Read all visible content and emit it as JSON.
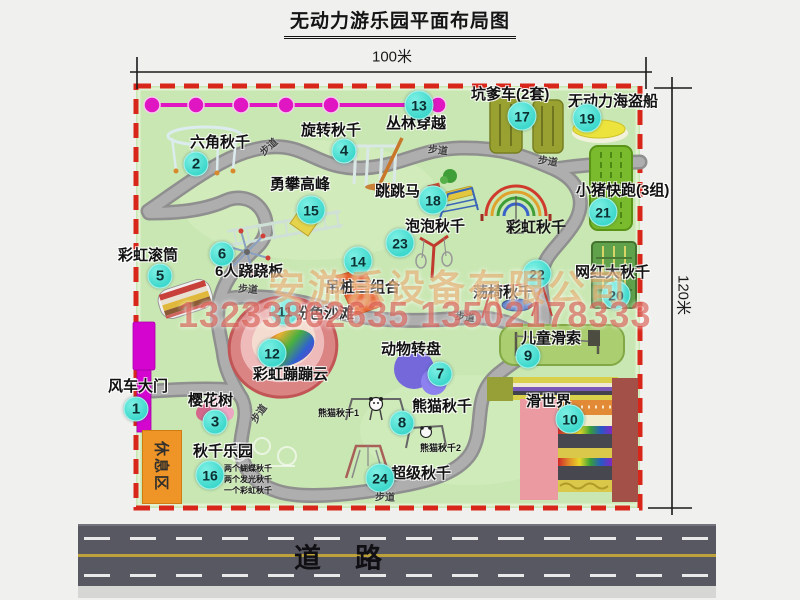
{
  "title": "无动力游乐园平面布局图",
  "dimensions": {
    "width": "100米",
    "height": "120米"
  },
  "road": {
    "label": "道路"
  },
  "watermark": {
    "company": "安游乐设备有限公司",
    "phones": "13233862635 13502178333"
  },
  "rest_area": "休息区",
  "walkway_label": "步道",
  "colors": {
    "park_green": "#c9e7b2",
    "border_red": "#d9261b",
    "marker_cyan": "#3ed8cc",
    "chain_magenta": "#df16c1",
    "gate_magenta": "#d405cf",
    "rest_orange": "#ef9426",
    "road_gray": "#585862"
  },
  "features": [
    {
      "num": "1",
      "label": "风车大门",
      "marker": [
        136,
        409
      ],
      "label_pos": [
        108,
        379
      ]
    },
    {
      "num": "2",
      "label": "六角秋千",
      "marker": [
        196,
        164
      ],
      "label_pos": [
        190,
        135
      ]
    },
    {
      "num": "3",
      "label": "樱花树",
      "marker": [
        215,
        422
      ],
      "label_pos": [
        188,
        393
      ]
    },
    {
      "num": "4",
      "label": "旋转秋千",
      "marker": [
        344,
        151
      ],
      "label_pos": [
        301,
        123
      ]
    },
    {
      "num": "5",
      "label": "彩虹滚筒",
      "marker": [
        160,
        276
      ],
      "label_pos": [
        118,
        248
      ]
    },
    {
      "num": "6",
      "label": "6人跷跷板",
      "marker": [
        222,
        254
      ],
      "label_pos": [
        215,
        264
      ]
    },
    {
      "num": "7",
      "label": "动物转盘",
      "marker": [
        440,
        374
      ],
      "label_pos": [
        381,
        342
      ]
    },
    {
      "num": "8",
      "label": "熊猫秋千",
      "marker": [
        402,
        423
      ],
      "label_pos": [
        412,
        399
      ]
    },
    {
      "num": "9",
      "label": "儿童滑索",
      "marker": [
        528,
        356
      ],
      "label_pos": [
        521,
        331
      ]
    },
    {
      "num": "10",
      "label": "滑世界",
      "marker": [
        570,
        419
      ],
      "label_pos": [
        526,
        394
      ]
    },
    {
      "num": "11",
      "label": "粉色沙滩",
      "marker": [
        285,
        311
      ],
      "label_pos": [
        294,
        306
      ]
    },
    {
      "num": "12",
      "label": "彩虹蹦蹦云",
      "marker": [
        272,
        353
      ],
      "label_pos": [
        253,
        367
      ]
    },
    {
      "num": "13",
      "label": "丛林穿越",
      "marker": [
        419,
        105
      ],
      "label_pos": [
        386,
        116
      ]
    },
    {
      "num": "14",
      "label": "吊桩三组合",
      "marker": [
        358,
        261
      ],
      "label_pos": [
        325,
        280
      ]
    },
    {
      "num": "15",
      "label": "勇攀高峰",
      "marker": [
        311,
        210
      ],
      "label_pos": [
        270,
        177
      ]
    },
    {
      "num": "16",
      "label": "秋千乐园",
      "marker": [
        210,
        475
      ],
      "label_pos": [
        193,
        444
      ]
    },
    {
      "num": "17",
      "label": "坑爹车(2套)",
      "marker": [
        522,
        116
      ],
      "label_pos": [
        471,
        87
      ]
    },
    {
      "num": "18",
      "label": "跳跳马",
      "marker": [
        433,
        200
      ],
      "label_pos": [
        375,
        184
      ]
    },
    {
      "num": "19",
      "label": "无动力海盗船",
      "marker": [
        587,
        118
      ],
      "label_pos": [
        568,
        94
      ]
    },
    {
      "num": "20",
      "label": "网红大秋千",
      "marker": [
        616,
        295
      ],
      "label_pos": [
        575,
        265
      ]
    },
    {
      "num": "21",
      "label": "小猪快跑(3组)",
      "marker": [
        603,
        212
      ],
      "label_pos": [
        576,
        183
      ]
    },
    {
      "num": "22",
      "label": "荡椅秋千",
      "marker": [
        537,
        274
      ],
      "label_pos": [
        473,
        285
      ]
    },
    {
      "num": "23",
      "label": "泡泡秋千",
      "marker": [
        400,
        243
      ],
      "label_pos": [
        405,
        219
      ]
    },
    {
      "num": "24",
      "label": "超级秋千",
      "marker": [
        380,
        478
      ],
      "label_pos": [
        391,
        466
      ]
    }
  ],
  "extra_labels": [
    {
      "text": "彩虹秋千",
      "x": 506,
      "y": 216,
      "size": 15
    },
    {
      "text": "熊猫秋千1",
      "x": 318,
      "y": 406,
      "size": 9
    },
    {
      "text": "熊猫秋千2",
      "x": 420,
      "y": 441,
      "size": 9
    },
    {
      "text": "两个蝴蝶秋千",
      "x": 224,
      "y": 463,
      "size": 8
    },
    {
      "text": "两个发光秋千",
      "x": 224,
      "y": 474,
      "size": 8
    },
    {
      "text": "一个彩虹秋千",
      "x": 224,
      "y": 485,
      "size": 8
    }
  ],
  "walkways": [
    {
      "x": 268,
      "y": 146,
      "rot": -42
    },
    {
      "x": 438,
      "y": 149,
      "rot": 6
    },
    {
      "x": 548,
      "y": 160,
      "rot": 8
    },
    {
      "x": 248,
      "y": 288,
      "rot": 4
    },
    {
      "x": 465,
      "y": 316,
      "rot": 6
    },
    {
      "x": 258,
      "y": 413,
      "rot": -55
    },
    {
      "x": 385,
      "y": 496,
      "rot": 2
    }
  ]
}
